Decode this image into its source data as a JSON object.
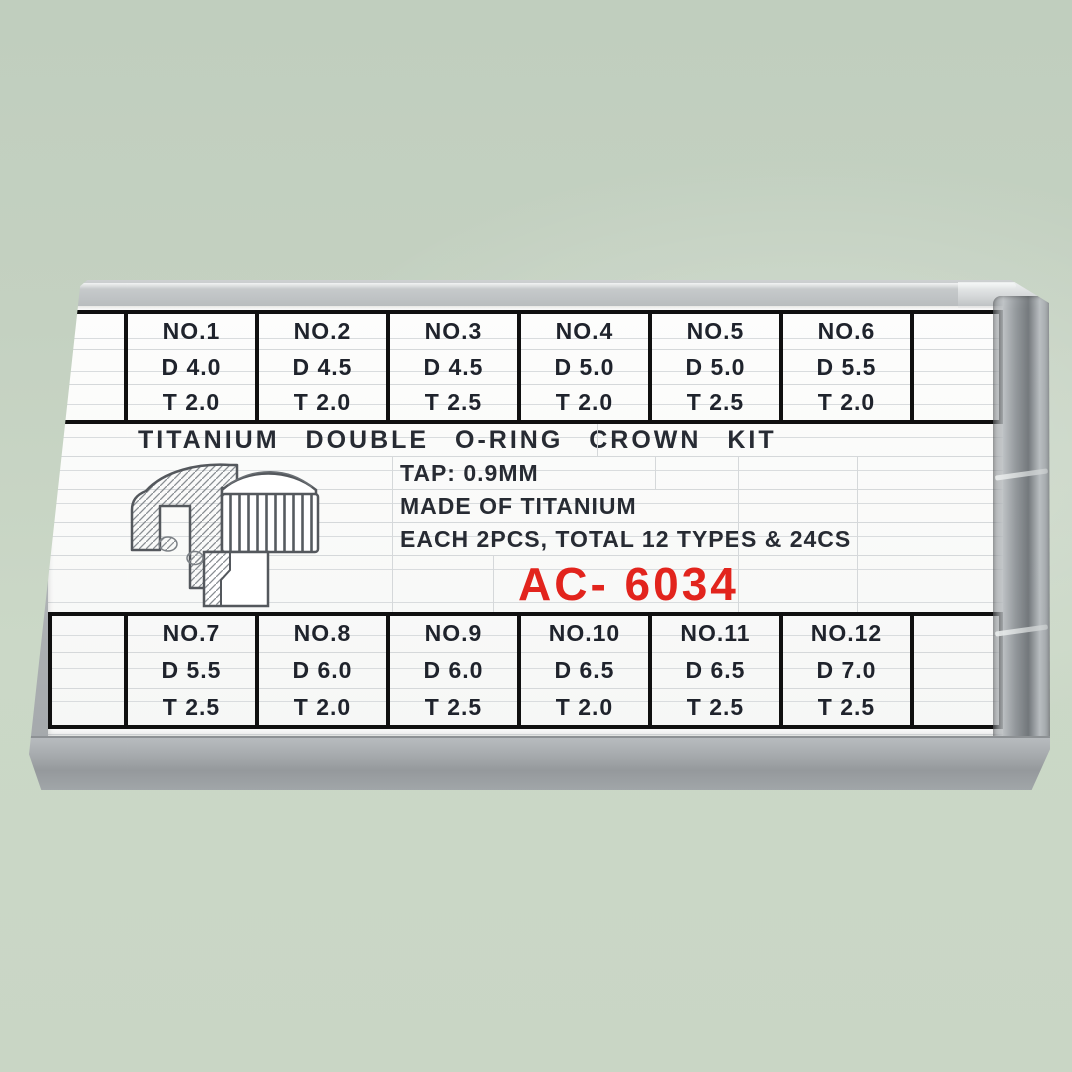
{
  "product": {
    "title": "TITANIUM  DOUBLE  O-RING  CROWN  KIT",
    "tap": "TAP: 0.9MM",
    "material": "MADE OF TITANIUM",
    "quantity": "EACH 2PCS, TOTAL 12 TYPES & 24CS",
    "model": "AC- 6034"
  },
  "size_table": {
    "top_row": [
      {
        "no": "NO.1",
        "d": "D 4.0",
        "t": "T 2.0"
      },
      {
        "no": "NO.2",
        "d": "D 4.5",
        "t": "T 2.0"
      },
      {
        "no": "NO.3",
        "d": "D 4.5",
        "t": "T 2.5"
      },
      {
        "no": "NO.4",
        "d": "D 5.0",
        "t": "T 2.0"
      },
      {
        "no": "NO.5",
        "d": "D 5.0",
        "t": "T 2.5"
      },
      {
        "no": "NO.6",
        "d": "D 5.5",
        "t": "T 2.0"
      }
    ],
    "bottom_row": [
      {
        "no": "NO.7",
        "d": "D 5.5",
        "t": "T 2.5"
      },
      {
        "no": "NO.8",
        "d": "D 6.0",
        "t": "T 2.0"
      },
      {
        "no": "NO.9",
        "d": "D 6.0",
        "t": "T 2.5"
      },
      {
        "no": "NO.10",
        "d": "D 6.5",
        "t": "T 2.0"
      },
      {
        "no": "NO.11",
        "d": "D 6.5",
        "t": "T 2.5"
      },
      {
        "no": "NO.12",
        "d": "D 7.0",
        "t": "T 2.5"
      }
    ]
  },
  "colors": {
    "background_green": "#c6d3c3",
    "case_gray": "#aeb2b5",
    "label_white": "#fbfbfa",
    "table_border_black": "#101010",
    "text_dark": "#22252d",
    "model_red": "#e2241d"
  },
  "icons": {
    "crown_diagram": "watch-crown-cross-section-diagram"
  }
}
